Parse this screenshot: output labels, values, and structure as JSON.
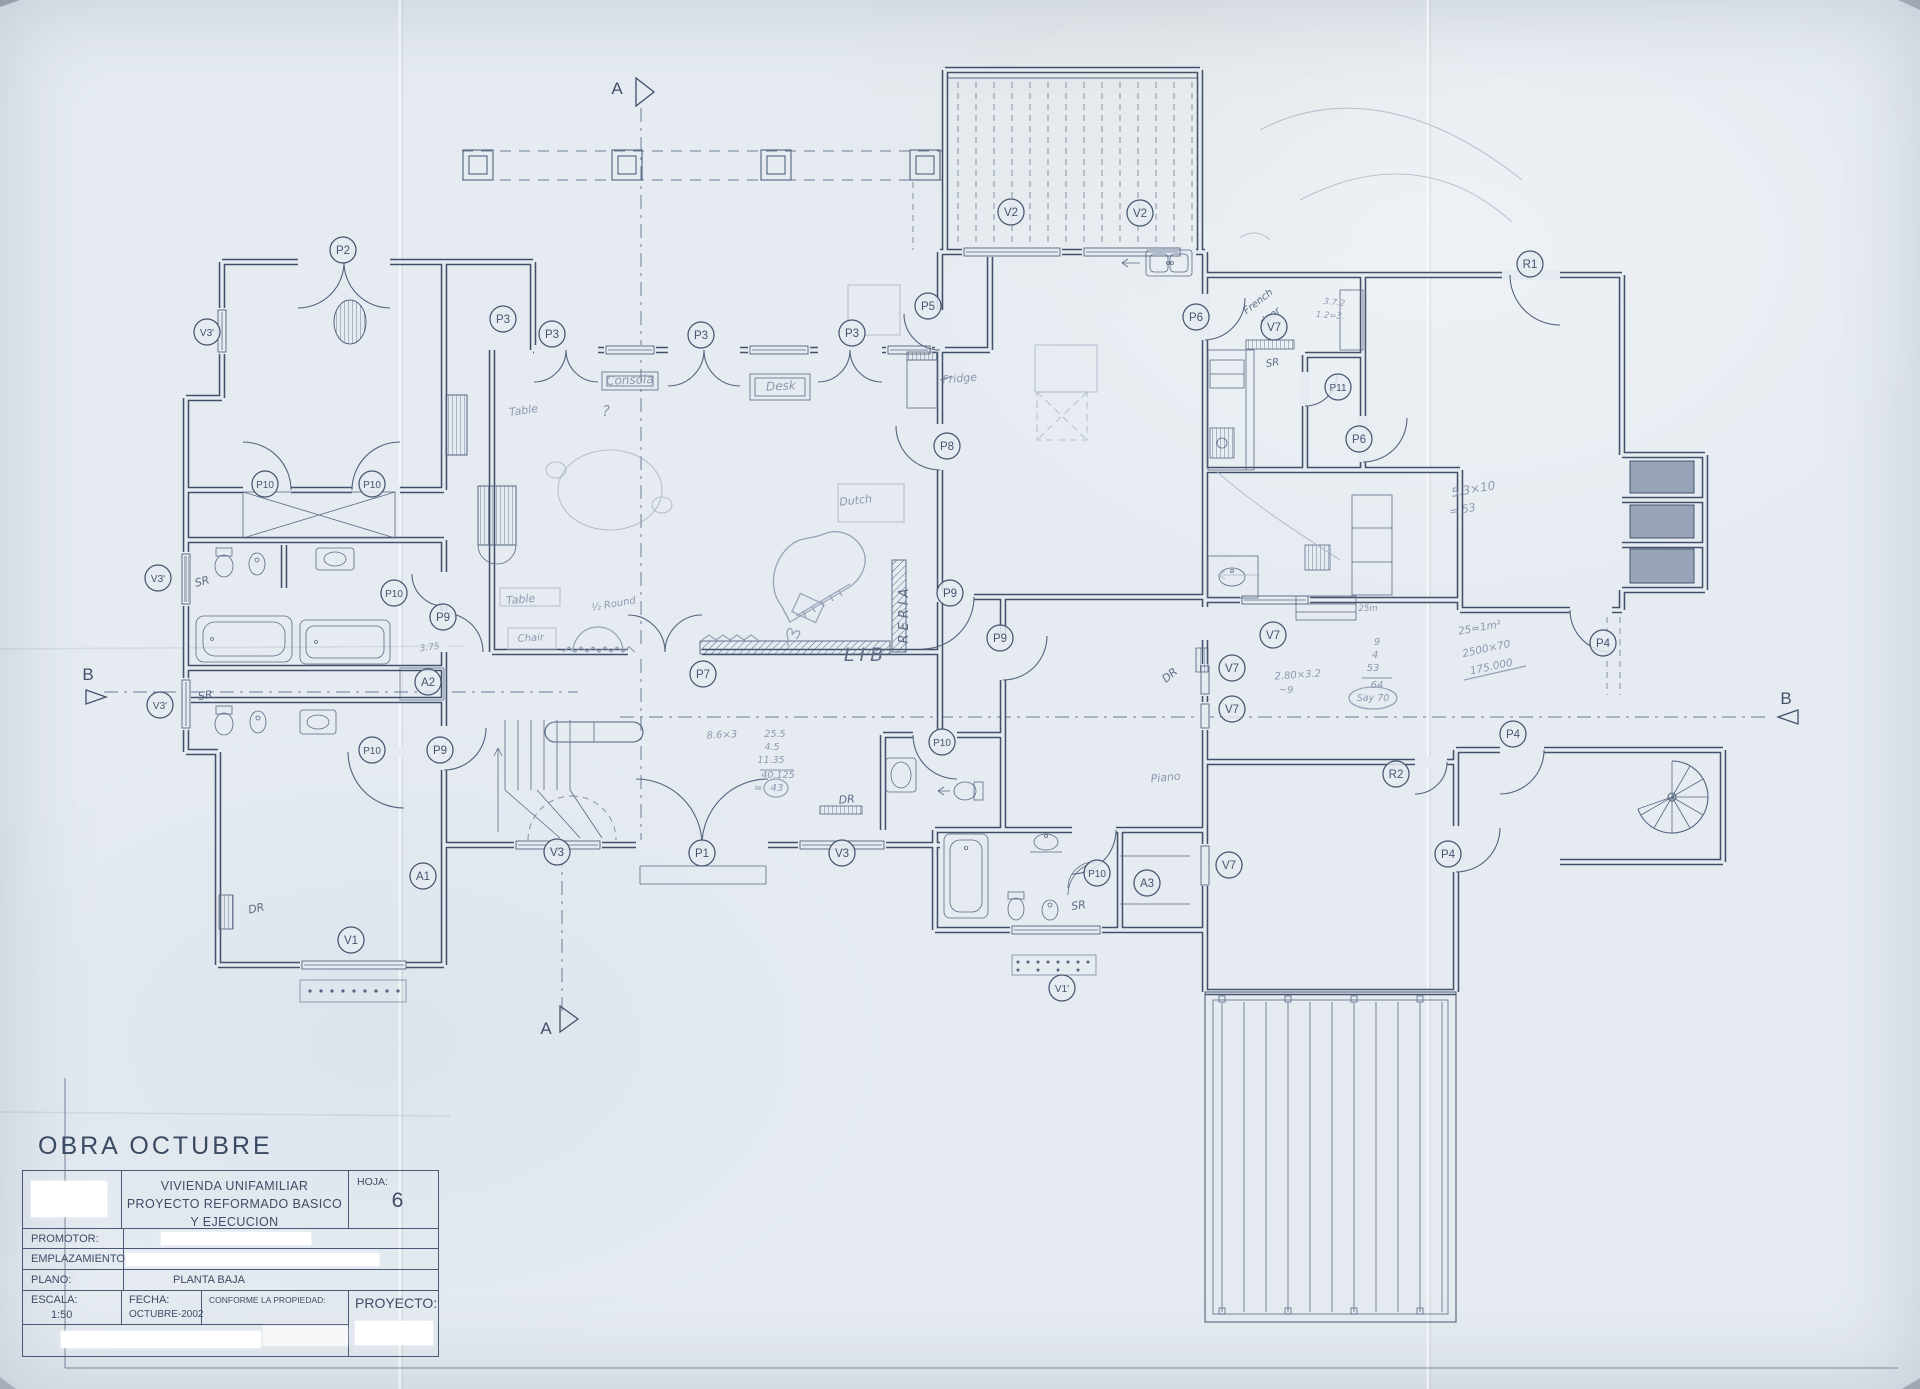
{
  "document": {
    "heading": "OBRA OCTUBRE",
    "title_block": {
      "project_title_lines": [
        "VIVIENDA UNIFAMILIAR",
        "PROYECTO REFORMADO BASICO",
        "Y EJECUCION"
      ],
      "sheet_label": "HOJA:",
      "sheet_number": "6",
      "promotor_label": "PROMOTOR:",
      "emplazamiento_label": "EMPLAZAMIENTO:",
      "plano_label": "PLANO:",
      "plano_value": "PLANTA BAJA",
      "escala_label": "ESCALA:",
      "escala_value": "1:50",
      "fecha_label": "FECHA:",
      "fecha_value": "OCTUBRE-2002",
      "conforme_label": "CONFORME LA PROPIEDAD:",
      "proyecto_label": "PROYECTO:"
    }
  },
  "colors": {
    "paper": "#e5ebf1",
    "ink": "#46546e",
    "pencil": "#98a3b8",
    "pen": "#5e6c86"
  },
  "plan": {
    "drawing_type": "ground-floor architectural plan, scanned pencil/ink on blue-grey paper",
    "labels": [
      {
        "t": "P2",
        "x": 343,
        "y": 250
      },
      {
        "t": "V3'",
        "x": 207,
        "y": 332
      },
      {
        "t": "P3",
        "x": 503,
        "y": 319
      },
      {
        "t": "P3",
        "x": 552,
        "y": 334
      },
      {
        "t": "P3",
        "x": 701,
        "y": 335
      },
      {
        "t": "P3",
        "x": 852,
        "y": 333
      },
      {
        "t": "P5",
        "x": 928,
        "y": 306
      },
      {
        "t": "V2",
        "x": 1011,
        "y": 212
      },
      {
        "t": "V2",
        "x": 1140,
        "y": 213
      },
      {
        "t": "P6",
        "x": 1196,
        "y": 317
      },
      {
        "t": "V7",
        "x": 1274,
        "y": 327
      },
      {
        "t": "R1",
        "x": 1530,
        "y": 264
      },
      {
        "t": "P11",
        "x": 1338,
        "y": 387
      },
      {
        "t": "P6",
        "x": 1359,
        "y": 439
      },
      {
        "t": "P8",
        "x": 947,
        "y": 446
      },
      {
        "t": "P10",
        "x": 265,
        "y": 484
      },
      {
        "t": "P10",
        "x": 372,
        "y": 484
      },
      {
        "t": "V3'",
        "x": 158,
        "y": 578
      },
      {
        "t": "P10",
        "x": 394,
        "y": 593
      },
      {
        "t": "P9",
        "x": 443,
        "y": 617
      },
      {
        "t": "A2",
        "x": 428,
        "y": 682
      },
      {
        "t": "V3'",
        "x": 160,
        "y": 705
      },
      {
        "t": "P9",
        "x": 440,
        "y": 750
      },
      {
        "t": "P10",
        "x": 372,
        "y": 750
      },
      {
        "t": "P7",
        "x": 703,
        "y": 674
      },
      {
        "t": "P9",
        "x": 950,
        "y": 593
      },
      {
        "t": "P9",
        "x": 1000,
        "y": 638
      },
      {
        "t": "P10",
        "x": 942,
        "y": 742
      },
      {
        "t": "P10",
        "x": 1097,
        "y": 873
      },
      {
        "t": "A3",
        "x": 1147,
        "y": 883
      },
      {
        "t": "V3",
        "x": 557,
        "y": 852
      },
      {
        "t": "P1",
        "x": 702,
        "y": 853
      },
      {
        "t": "V3",
        "x": 842,
        "y": 853
      },
      {
        "t": "A1",
        "x": 423,
        "y": 876
      },
      {
        "t": "V1",
        "x": 351,
        "y": 940
      },
      {
        "t": "V1'",
        "x": 1062,
        "y": 988
      },
      {
        "t": "V7",
        "x": 1273,
        "y": 635
      },
      {
        "t": "V7",
        "x": 1232,
        "y": 668
      },
      {
        "t": "V7",
        "x": 1232,
        "y": 709
      },
      {
        "t": "V7",
        "x": 1229,
        "y": 865
      },
      {
        "t": "R2",
        "x": 1396,
        "y": 774
      },
      {
        "t": "P4",
        "x": 1603,
        "y": 643
      },
      {
        "t": "P4",
        "x": 1513,
        "y": 734
      },
      {
        "t": "P4",
        "x": 1448,
        "y": 854
      }
    ],
    "section_markers": [
      {
        "letter": "A",
        "x": 617,
        "y": 94,
        "tri": "636,78 636,106 654,92"
      },
      {
        "letter": "A",
        "x": 546,
        "y": 1034,
        "tri": "560,1006 560,1032 578,1019"
      },
      {
        "letter": "B",
        "x": 88,
        "y": 680,
        "tri": "86,690 106,697 86,704"
      },
      {
        "letter": "B",
        "x": 1786,
        "y": 704,
        "tri": "1798,710 1778,717 1798,724"
      }
    ],
    "annotations": [
      {
        "t": "Consola",
        "x": 630,
        "y": 384,
        "s": 12,
        "c": "pc",
        "r": -2
      },
      {
        "t": "Desk",
        "x": 781,
        "y": 390,
        "s": 12,
        "c": "pc",
        "r": -3
      },
      {
        "t": "Table",
        "x": 524,
        "y": 414,
        "s": 11,
        "c": "pc",
        "r": -8
      },
      {
        "t": "?",
        "x": 606,
        "y": 416,
        "s": 15,
        "c": "pc"
      },
      {
        "t": "Fridge",
        "x": 960,
        "y": 382,
        "s": 11,
        "c": "pc",
        "r": -5
      },
      {
        "t": "Dutch",
        "x": 856,
        "y": 504,
        "s": 11,
        "c": "pc",
        "r": -6
      },
      {
        "t": "Table",
        "x": 521,
        "y": 603,
        "s": 11,
        "c": "pc",
        "r": -5
      },
      {
        "t": "Chair",
        "x": 531,
        "y": 641,
        "s": 10,
        "c": "pc",
        "r": -3
      },
      {
        "t": "½ Round",
        "x": 614,
        "y": 607,
        "s": 10,
        "c": "pc",
        "r": -10
      },
      {
        "t": "LIB",
        "x": 866,
        "y": 661,
        "s": 19,
        "c": "pen",
        "ls": 5
      },
      {
        "t": "RERIA",
        "x": 908,
        "y": 614,
        "s": 13,
        "c": "pen",
        "r": -90,
        "ls": 4
      },
      {
        "t": "SR",
        "x": 203,
        "y": 585,
        "s": 11,
        "c": "pen",
        "r": -15
      },
      {
        "t": "SR",
        "x": 206,
        "y": 699,
        "s": 11,
        "c": "pen",
        "r": -10
      },
      {
        "t": "DR",
        "x": 257,
        "y": 912,
        "s": 11,
        "c": "pen",
        "r": -12
      },
      {
        "t": "DR",
        "x": 847,
        "y": 803,
        "s": 11,
        "c": "pen",
        "r": -5
      },
      {
        "t": "SR",
        "x": 1079,
        "y": 909,
        "s": 11,
        "c": "pen",
        "r": -8
      },
      {
        "t": "DR",
        "x": 1172,
        "y": 678,
        "s": 11,
        "c": "pen",
        "r": -40
      },
      {
        "t": "SR",
        "x": 1273,
        "y": 366,
        "s": 10,
        "c": "pen",
        "r": -10
      },
      {
        "t": "French",
        "x": 1260,
        "y": 304,
        "s": 10,
        "c": "pen",
        "r": -38
      },
      {
        "t": "door",
        "x": 1272,
        "y": 319,
        "s": 10,
        "c": "pen",
        "r": -38
      },
      {
        "t": "3.75",
        "x": 430,
        "y": 650,
        "s": 9,
        "c": "pc",
        "r": -8
      },
      {
        "t": "8.6×3",
        "x": 722,
        "y": 738,
        "s": 10,
        "c": "pc",
        "r": -3
      },
      {
        "t": "25.5",
        "x": 775,
        "y": 737,
        "s": 9.5,
        "c": "pc"
      },
      {
        "t": "4.5",
        "x": 772,
        "y": 750,
        "s": 9.5,
        "c": "pc"
      },
      {
        "t": "11.35",
        "x": 771,
        "y": 763,
        "s": 9.5,
        "c": "pc"
      },
      {
        "t": "40.125",
        "x": 778,
        "y": 778,
        "s": 9.5,
        "c": "pc"
      },
      {
        "t": "≈",
        "x": 758,
        "y": 791,
        "s": 10,
        "c": "pc"
      },
      {
        "t": "43",
        "x": 777,
        "y": 791,
        "s": 10,
        "c": "pc"
      },
      {
        "t": "9",
        "x": 1377,
        "y": 645,
        "s": 10,
        "c": "pc"
      },
      {
        "t": "4",
        "x": 1375,
        "y": 658,
        "s": 10,
        "c": "pc"
      },
      {
        "t": "53",
        "x": 1373,
        "y": 671,
        "s": 10,
        "c": "pc"
      },
      {
        "t": "64",
        "x": 1377,
        "y": 688,
        "s": 10,
        "c": "pc"
      },
      {
        "t": "Say 70",
        "x": 1373,
        "y": 701,
        "s": 9.5,
        "c": "pc"
      },
      {
        "t": "2.80×3.2",
        "x": 1298,
        "y": 678,
        "s": 10,
        "c": "pc",
        "r": -4
      },
      {
        "t": "~9",
        "x": 1286,
        "y": 693,
        "s": 10,
        "c": "pc"
      },
      {
        "t": "5.3×10",
        "x": 1474,
        "y": 493,
        "s": 12,
        "c": "pc",
        "r": -10
      },
      {
        "t": "= 53",
        "x": 1463,
        "y": 513,
        "s": 11,
        "c": "pc",
        "r": -10
      },
      {
        "t": "25=1m²",
        "x": 1480,
        "y": 631,
        "s": 10.5,
        "c": "pc",
        "r": -10
      },
      {
        "t": "2500×70",
        "x": 1487,
        "y": 652,
        "s": 10.5,
        "c": "pc",
        "r": -12
      },
      {
        "t": "175.000",
        "x": 1492,
        "y": 670,
        "s": 10.5,
        "c": "pc",
        "r": -12
      },
      {
        "t": "3.7.2",
        "x": 1334,
        "y": 305,
        "s": 8.5,
        "c": "pc",
        "r": 6
      },
      {
        "t": "1.2=3.",
        "x": 1330,
        "y": 318,
        "s": 8.5,
        "c": "pc",
        "r": 4
      },
      {
        "t": "Piano",
        "x": 1166,
        "y": 781,
        "s": 11,
        "c": "pc",
        "r": -6
      },
      {
        "t": "25m",
        "x": 1368,
        "y": 611,
        "s": 8.5,
        "c": "pc"
      }
    ]
  }
}
